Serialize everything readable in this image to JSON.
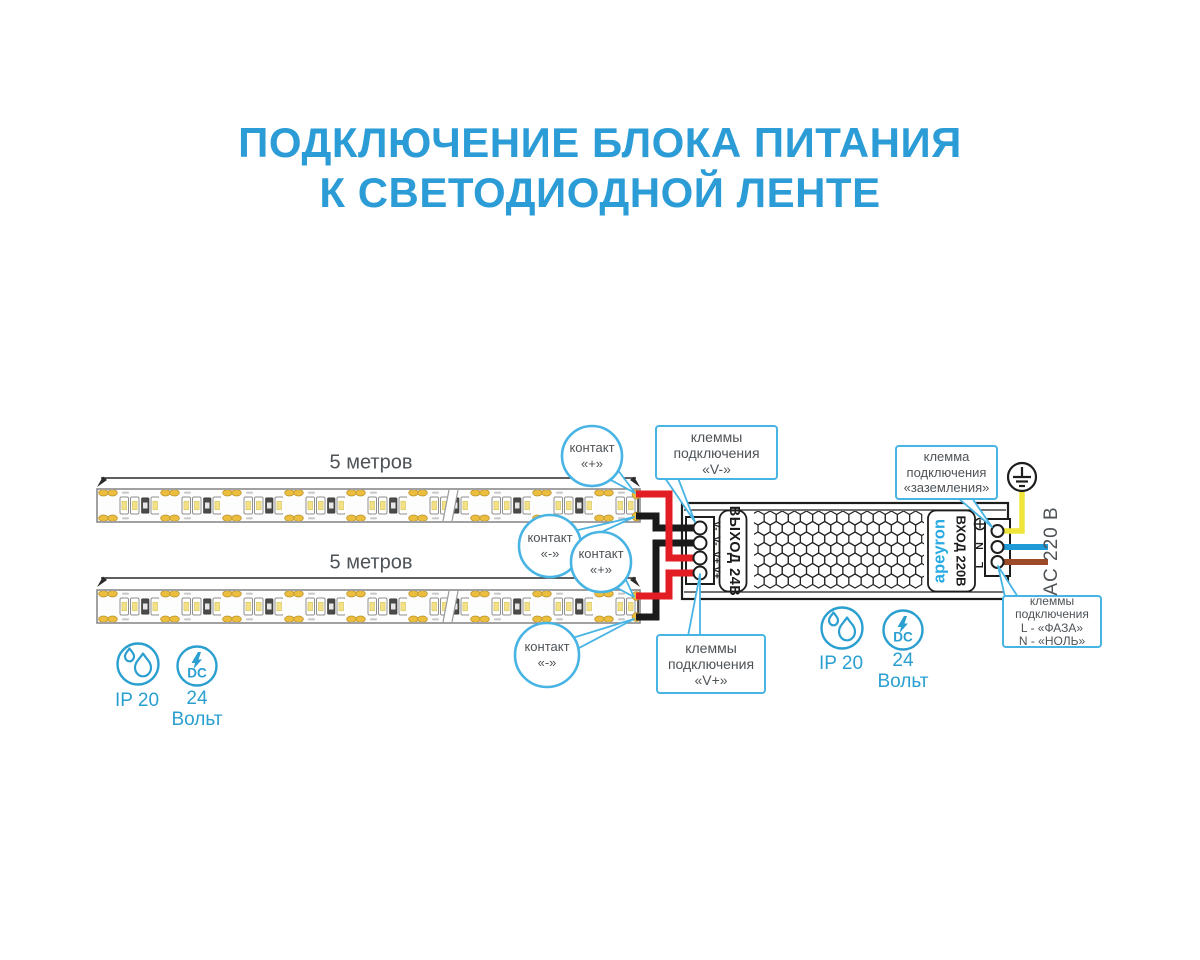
{
  "title": {
    "line1": "ПОДКЛЮЧЕНИЕ БЛОКА ПИТАНИЯ",
    "line2": "К СВЕТОДИОДНОЙ ЛЕНТЕ"
  },
  "strips": [
    {
      "length_label": "5 метров"
    },
    {
      "length_label": "5 метров"
    }
  ],
  "callouts": {
    "contact": [
      {
        "label": "контакт",
        "value": "«+»"
      },
      {
        "label": "контакт",
        "value": "«-»"
      },
      {
        "label": "контакт",
        "value": "«+»"
      },
      {
        "label": "контакт",
        "value": "«-»"
      }
    ],
    "v_minus": {
      "line1": "клеммы",
      "line2": "подключения",
      "line3": "«V-»"
    },
    "v_plus": {
      "line1": "клеммы",
      "line2": "подключения",
      "line3": "«V+»"
    },
    "ground": {
      "line1": "клемма",
      "line2": "подключения",
      "line3": "«заземления»"
    },
    "mains": {
      "line1": "клеммы",
      "line2": "подключения",
      "line3": "L - «ФАЗА»",
      "line4": "N - «НОЛЬ»"
    }
  },
  "psu": {
    "output_label": "ВЫХОД 24В",
    "output_terminal_labels": "V-  V-  V+ V+",
    "brand": "apeyron",
    "input_label": "ВХОД 220В",
    "input_terminal_n": "N",
    "input_terminal_l": "L"
  },
  "mains_label": "AC 220 В",
  "badges": {
    "ip": "IP 20",
    "dc": "DC",
    "voltage": "24",
    "voltage_unit": "Вольт"
  },
  "colors": {
    "accent": "#48b4e4",
    "title-blue": "#2b9cd6",
    "text": "#4e5357",
    "wire-red": "#e21d24",
    "wire-black": "#1a1a1a",
    "wire-yellow": "#efe53a",
    "wire-blue": "#1e9ad6",
    "wire-brown": "#9c4a28",
    "gold": "#ecbe3d",
    "icon-blue": "#2a9fd0",
    "brand-blue": "#29abe2",
    "outline": "#1d1d1b"
  }
}
